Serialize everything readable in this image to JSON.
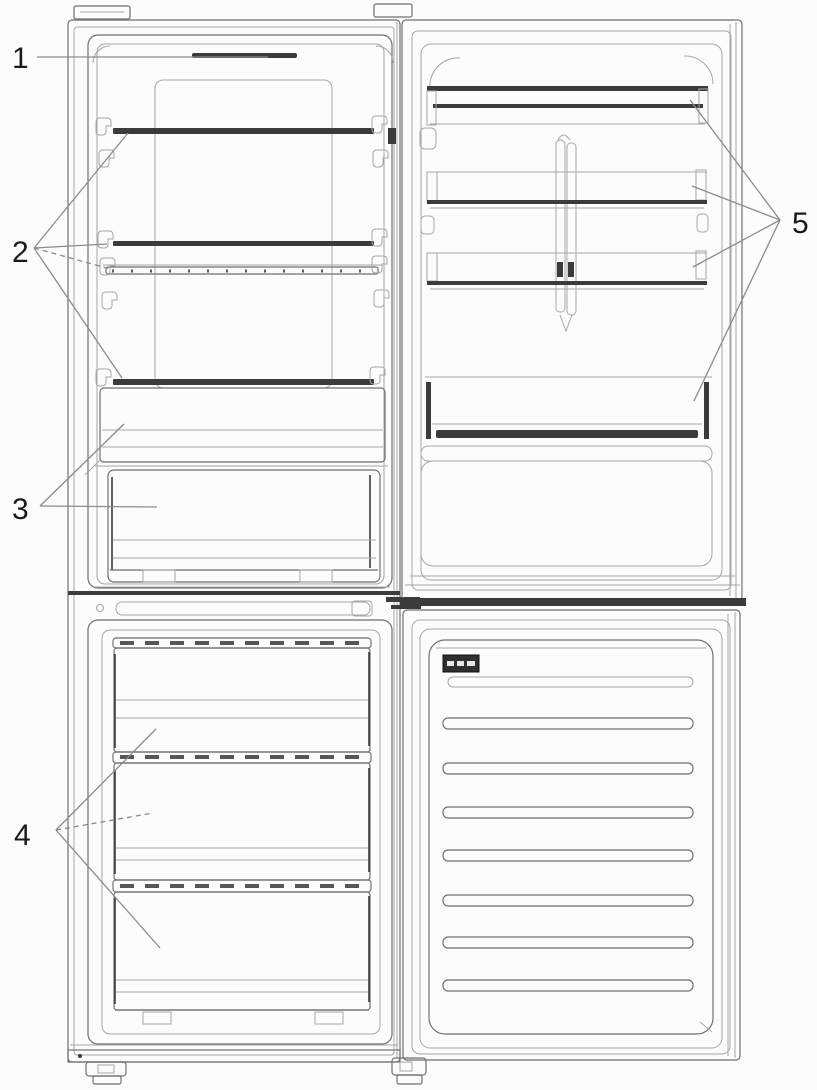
{
  "figure": {
    "callouts": [
      {
        "label": "1"
      },
      {
        "label": "2"
      },
      {
        "label": "3"
      },
      {
        "label": "4"
      },
      {
        "label": "5"
      }
    ]
  },
  "colors": {
    "background": "#fcfcfc",
    "line": "#707070",
    "line_light": "#a6a6a6",
    "line_dark": "#3b3b3b",
    "label_text": "#1a1a1a"
  }
}
